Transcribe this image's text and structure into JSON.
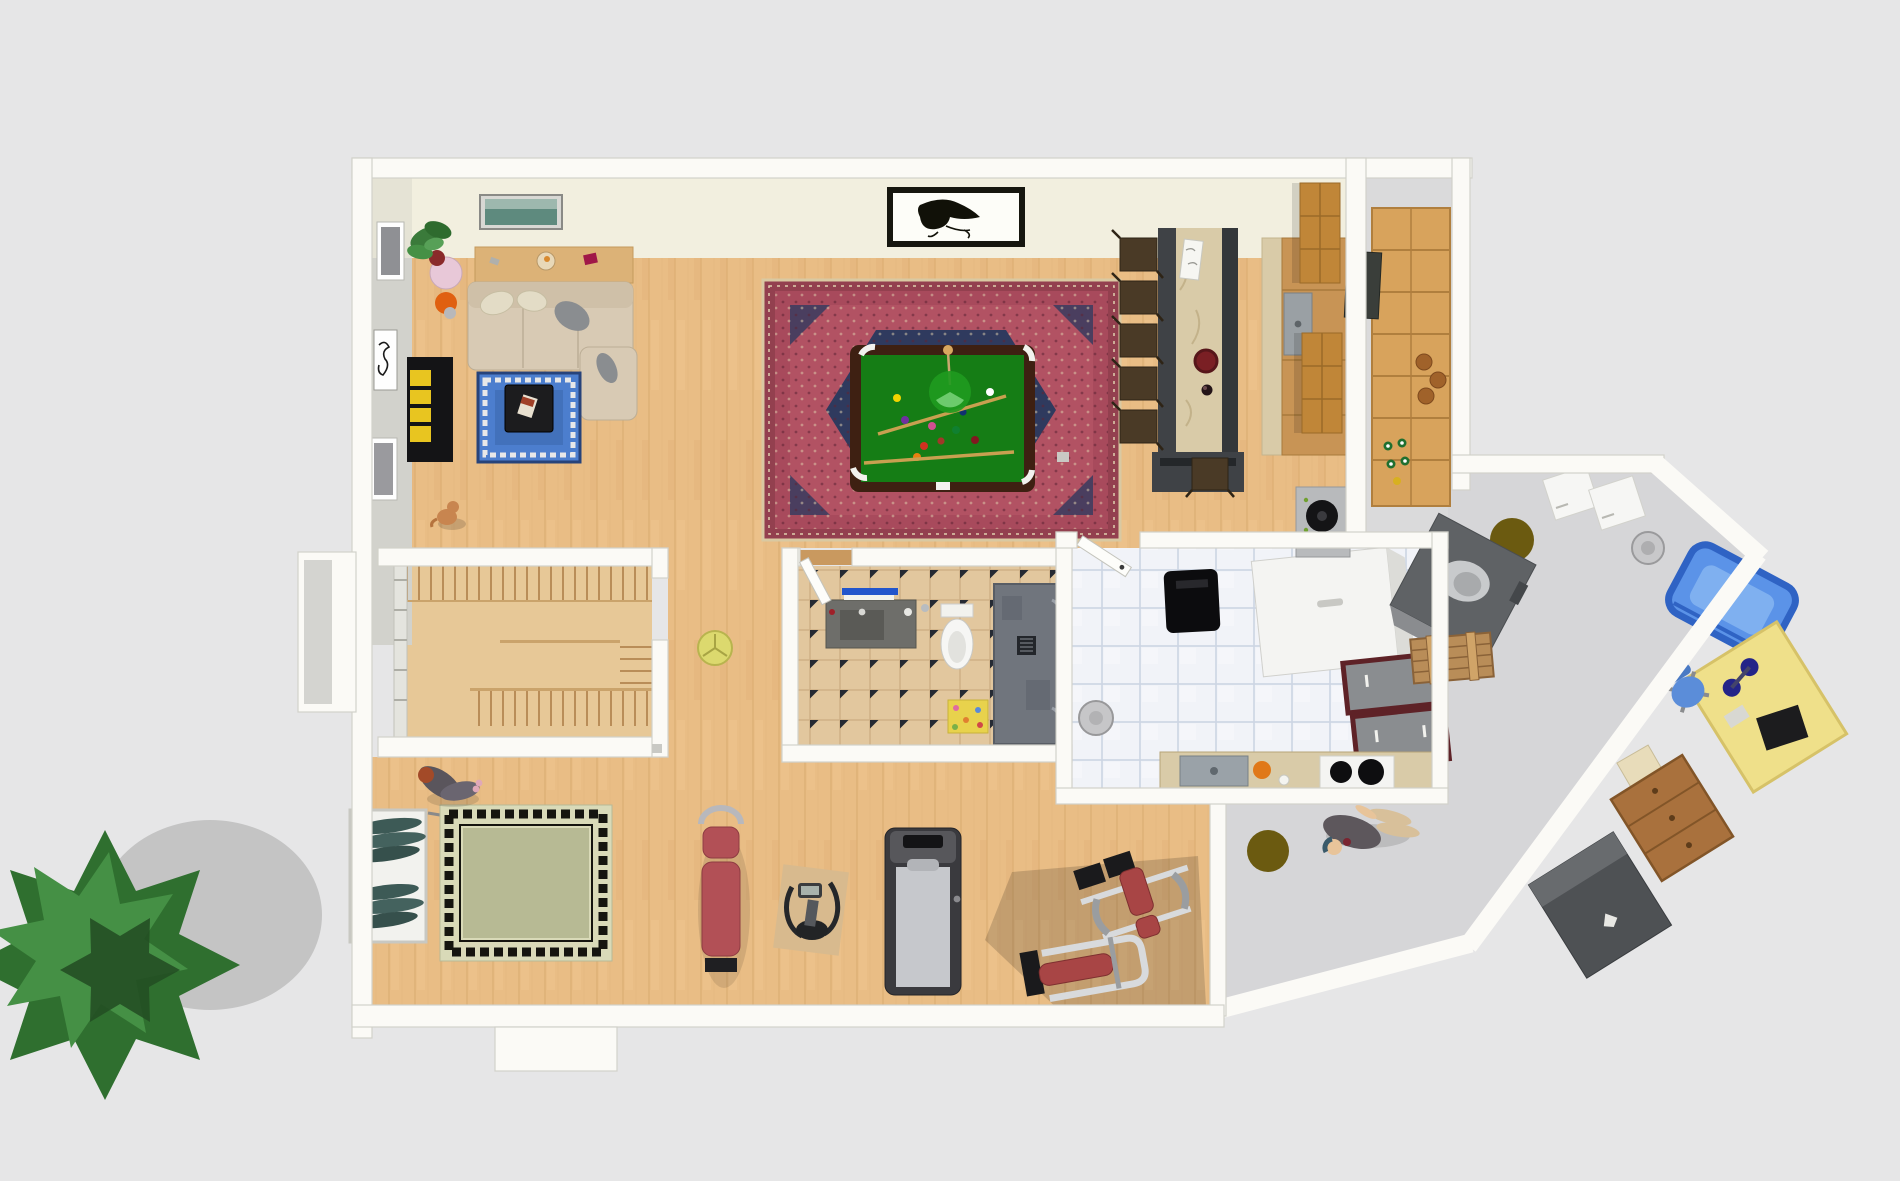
{
  "scene": {
    "type": "3d-floor-plan-render",
    "view": "aerial-top-down",
    "level": "basement"
  },
  "palette": {
    "bg": "#e6e6e7",
    "wallFill": "#fbfaf6",
    "wallEdge": "#d2d1ca",
    "wallFaceGray": "#d2d2cc",
    "creamWall": "#f2efdf",
    "wood": "#e9bd85",
    "woodLine": "#d3a468",
    "concrete": "#d6d6d8",
    "concreteLight": "#dadadb",
    "tileBeige": "#e2c79e",
    "tileDiamond": "#252a33",
    "laundryTile": "#f1f3f8",
    "laundryTileLine": "#ccd5e3",
    "rugRedOuter": "#93404f",
    "rugRedBand": "#a84a5c",
    "rugRedField": "#b25263",
    "rugNavy": "#2f3a5e",
    "rugCream": "#e8dcc0",
    "feltGreen": "#157d15",
    "tableWood": "#3e2012",
    "lampGreen": "#1f9a1f",
    "rugBlue": "#4c7ece",
    "gymRugField": "#b7ba94",
    "gymRugBand": "#d9dab8",
    "gymRugKey": "#15150f",
    "sofaBeige": "#d8cab4",
    "sofaBack": "#cfc0a8",
    "pillowGray": "#8a8d90",
    "marble": "#d9cba8",
    "barDark": "#3f4246",
    "stoolBrown": "#4a3a26",
    "cabinetWood": "#c89455",
    "cabinetUpper": "#c08638",
    "shelfWood": "#d8a35c",
    "furnaceGray": "#5f6265",
    "crateWood": "#b98d58",
    "sledBlue": "#5b93e8",
    "deskYellow": "#efe08a",
    "chairBlue": "#5b8dd9",
    "dresserWood": "#a9713d",
    "darkCabinet": "#4e5154",
    "treeGreen": "#2f6f2f",
    "treeGreenLight": "#459045",
    "treeGreenDark": "#234f23",
    "shadowGray": "#bdbdbd",
    "benchRed": "#b25056",
    "treadmillDark": "#3a3a3e",
    "treadmillBelt": "#c6c8cc",
    "machineRed": "#a84545",
    "machineFrame": "#d8dadc",
    "matGreen": "#3d5a56",
    "toiletWhite": "#f6f6f4",
    "vanityGray": "#6e6e6a",
    "showerGray": "#70757d",
    "towelBlue": "#2255cc",
    "fridgeWhite": "#f4f4f2",
    "maroonCabinet": "#5e2227",
    "stoveBlack": "#0c0c0e",
    "basinGray": "#c6c6c8",
    "personJacket": "#5d575c",
    "personSkin": "#e8c49a",
    "personPants": "#d8c09a",
    "oliveDisc": "#6b5a10",
    "yellowDisc": "#dcd96e",
    "dogBrown": "#c8854f",
    "tvBlack": "#17171a",
    "stairTread": "#e7c897",
    "yellowShelf": "#e8c520",
    "orangeLamp": "#e06010",
    "plantPotPink": "#e8c8d8"
  },
  "rooms": [
    {
      "name": "billiard-room",
      "items": [
        "persian-rug",
        "pool-table",
        "billiard-balls",
        "two-cues",
        "green-pendant-lamp",
        "portrait-sketch-picture",
        "landscape-picture",
        "bar-counter",
        "bar-stools-x6",
        "bar-menu",
        "serving-tray",
        "wine-bottle",
        "kitchen-cabinets",
        "kitchen-sink",
        "upper-cabinets"
      ]
    },
    {
      "name": "living-corner",
      "items": [
        "sectional-sofa",
        "console-table",
        "clock-bowl-book",
        "blue-rug",
        "coffee-table",
        "magazine",
        "tv-cabinet",
        "yellow-ladder-shelf",
        "potted-plant",
        "side-table",
        "orange-lamp",
        "wall-pictures-x3",
        "dog"
      ]
    },
    {
      "name": "staircase-room",
      "items": [
        "u-shaped-wood-stairs",
        "railing"
      ]
    },
    {
      "name": "bathroom",
      "items": [
        "vanity-sink",
        "blue-towel",
        "toilet",
        "shower-stall",
        "flower-bath-mat",
        "checker-tile-floor"
      ]
    },
    {
      "name": "laundry-kitchenette",
      "items": [
        "black-grill-stove",
        "refrigerator",
        "maroon-cabinets",
        "counter-sink",
        "two-burner-cooktop",
        "orange-bowl",
        "floor-basin",
        "kettle-on-cabinet",
        "open-door"
      ]
    },
    {
      "name": "pantry",
      "items": [
        "long-wood-shelving",
        "clay-pots",
        "bottles",
        "dark-storage-box"
      ]
    },
    {
      "name": "utility-area",
      "items": [
        "furnace",
        "wood-crate",
        "white-boxes-x2",
        "bin-lid",
        "blue-sled",
        "yellow-workbench",
        "laptop",
        "blue-office-chair",
        "wood-dresser",
        "dark-cabinet",
        "person-lying",
        "olive-floor-discs"
      ]
    },
    {
      "name": "gym",
      "items": [
        "mat-rack",
        "rolled-mats",
        "greek-key-rug",
        "person-stretching",
        "red-weight-bench",
        "elliptical-trainer",
        "treadmill",
        "weight-machine-press",
        "weight-machine-bench",
        "wall-tv",
        "yellow-floor-cushion"
      ]
    },
    {
      "name": "exterior",
      "items": [
        "large-tree",
        "tree-shadow"
      ]
    }
  ]
}
